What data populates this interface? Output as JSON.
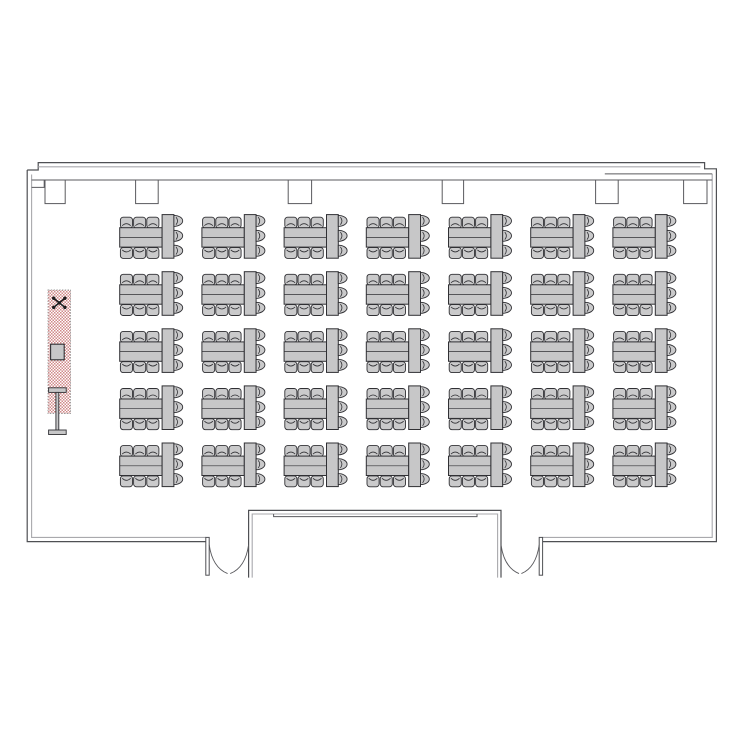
{
  "page": {
    "background": "#ffffff",
    "width": 750,
    "height": 750,
    "title": "meeting-room-classroom-floorplan"
  },
  "colors": {
    "wallDark": "#4f5054",
    "wallLight": "#a9a9ad",
    "line": "#5a5a5e",
    "tableFill": "#c7c7c8",
    "chairFill": "#cacacb",
    "shapeStroke": "#303034",
    "hatchPink": "#d08a8a",
    "hatchBorder": "#9a9a9a",
    "symbolInk": "#1d1d1f",
    "white": "#ffffff"
  },
  "walls": [
    {
      "id": "left-and-bottom-left-outer",
      "d": "M 27.2,170 L 27.2,541.6 L 205.8,541.6",
      "c": "wallDark",
      "w": 1.2
    },
    {
      "id": "top-right-and-bottom-right-outer",
      "d": "M 27.2,170 L 38.2,170 L 38.2,162.6 L 704.6,162.6 L 704.6,168.8 L 716.4,168.8 L 716.4,541.6 L 542.6,541.6",
      "c": "wallDark",
      "w": 1.2
    },
    {
      "id": "left-and-bottom-left-inner",
      "d": "M 31.6,174.5 L 31.6,537.4 L 205.8,537.4",
      "c": "wallLight",
      "w": 1.1
    },
    {
      "id": "top-inner",
      "d": "M 38.2,166.8 L 700.4,166.8",
      "c": "wallLight",
      "w": 1.1
    },
    {
      "id": "right-and-bottom-right-inner",
      "d": "M 712.2,173.9 L 712.2,537.4 L 542.6,537.4",
      "c": "wallLight",
      "w": 1.1
    },
    {
      "id": "ceiling-soffit-line",
      "d": "M 31.6,180 L 712.2,180",
      "c": "line",
      "w": 1
    },
    {
      "id": "top-left-step",
      "d": "M 31.6,187.4 L 44.2,187.4 L 44.2,180",
      "c": "line",
      "w": 1
    },
    {
      "id": "top-right-band",
      "d": "M 604.8,173.9 L 712.2,173.9",
      "c": "line",
      "w": 1
    },
    {
      "id": "vestibule-outer",
      "d": "M 248.6,577.6 L 248.6,510.4 L 501.0,510.4 L 501.0,577.6",
      "c": "wallDark",
      "w": 1.2
    },
    {
      "id": "vestibule-inner",
      "d": "M 252.2,577.6 L 252.2,514.0 L 497.6,514.0 L 497.6,577.6",
      "c": "wallLight",
      "w": 1.1
    },
    {
      "id": "vestibule-header-step",
      "d": "M 273.6,514.0 L 273.6,516.6 L 477.0,516.6 L 477.0,514.0",
      "c": "line",
      "w": 1
    }
  ],
  "doorJambs": [
    {
      "id": "left-entry-jamb",
      "x": 205.8,
      "y": 537.4,
      "w": 3.4,
      "h": 37.8
    },
    {
      "id": "right-entry-jamb",
      "x": 539.2,
      "y": 537.4,
      "w": 3.4,
      "h": 37.8
    }
  ],
  "doorArcs": [
    {
      "id": "left-entry-leaf-a",
      "d": "M 209.2,544.8 Q 212.4,567.5 227.6,573.6"
    },
    {
      "id": "left-entry-leaf-b",
      "d": "M 248.6,544.8 Q 245.4,567.5 230.2,573.6"
    },
    {
      "id": "right-entry-leaf-a",
      "d": "M 501.0,544.8 Q 504.2,567.5 519.0,573.6"
    },
    {
      "id": "right-entry-leaf-b",
      "d": "M 539.2,544.8 Q 536.0,567.5 521.4,573.6"
    }
  ],
  "pilasters": {
    "y": 180,
    "depth": 23.6,
    "spans": [
      [
        45.0,
        65.2
      ],
      [
        135.6,
        158.2
      ],
      [
        288.2,
        311.6
      ],
      [
        442.2,
        463.6
      ],
      [
        595.6,
        618.2
      ],
      [
        683.6,
        707.0
      ]
    ]
  },
  "tables": {
    "columns": 7,
    "rows": 5,
    "colStart": 119.7,
    "colPitch": 82.2,
    "rowStart": 214.6,
    "rowPitch": 57.1,
    "unit": {
      "vtable": [
        42.4,
        0,
        11.8,
        43.6
      ],
      "htable": [
        0,
        13.1,
        42.4,
        19.4
      ],
      "sideChair": {
        "w": 12.1,
        "h": 10.9,
        "rx": 2.8,
        "xs": [
          0.7,
          13.9,
          27.1
        ],
        "topY": 2.6,
        "bottomY": 32.9
      },
      "endChair": {
        "depth": 8.8,
        "halfH": 5.5,
        "cys": [
          6.3,
          21.2,
          36.1
        ],
        "flatX": 54.2
      }
    },
    "seats_per_unit": 9,
    "total_units": 35,
    "total_seats": 315
  },
  "stage": {
    "hatchRect": [
      48.0,
      290.0,
      22.5,
      123.5
    ],
    "ceilingSymbol": {
      "cx": 59.3,
      "cy": 302.8,
      "dx": 5.6,
      "dy": 4.6,
      "dotR": 1.7
    },
    "projectorSquare": [
      50.6,
      344.2,
      13.6,
      15.6
    ],
    "screen": {
      "bar": [
        48.6,
        387.8,
        17.6,
        4.6
      ],
      "stem": [
        55.9,
        392.4,
        2.9,
        37.8
      ],
      "base": [
        48.6,
        430.0,
        17.6,
        4.5
      ]
    }
  }
}
